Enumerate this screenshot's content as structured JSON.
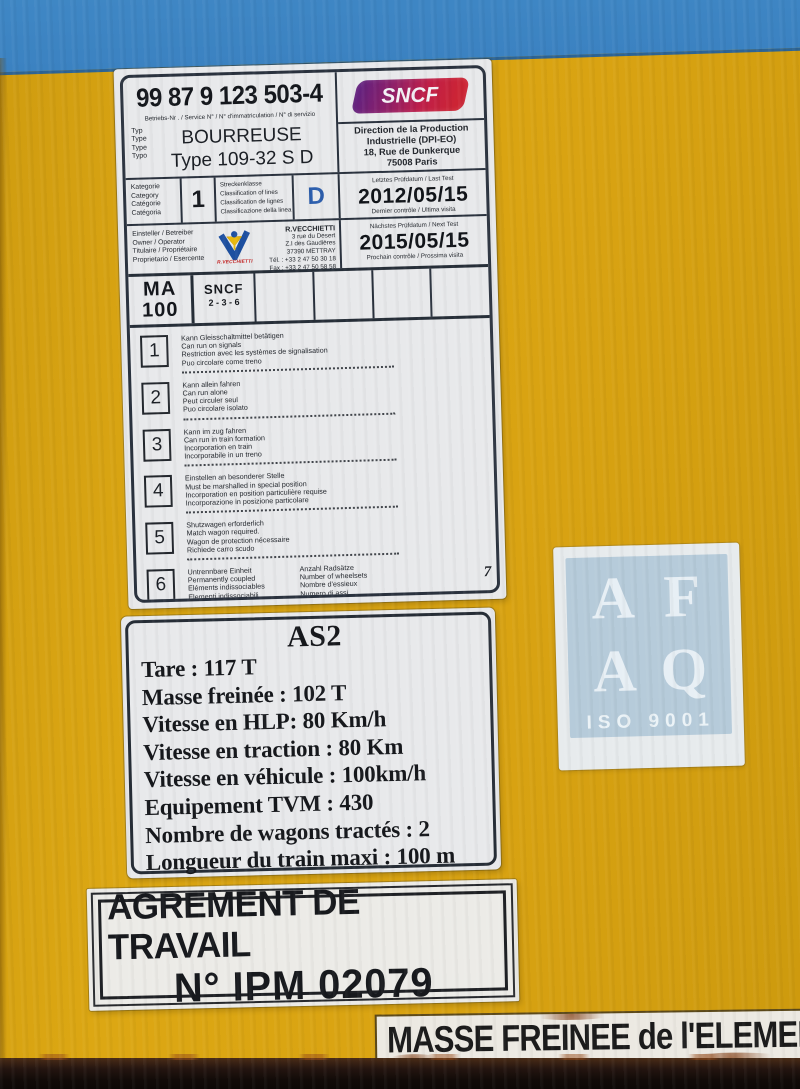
{
  "colors": {
    "sky_blue": "#3d86c5",
    "body_yellow": "#d9a312",
    "plate_bg": "#e8e9eb",
    "plate_border": "#2a323e",
    "class_d_blue": "#2d5fae",
    "sncf_purple": "#64217e",
    "sncf_red": "#cc2434",
    "vecchietti_red": "#c32222",
    "sticker_blue": "#b6cbda",
    "bottom_band": "#120b08"
  },
  "plate1": {
    "number": "99 87 9 123 503-4",
    "number_label": "Betriebs-Nr . / Service N° / N° d'immatriculation / N° di servizio",
    "type_labels": [
      "Typ",
      "Type",
      "Type",
      "Typo"
    ],
    "type_name": "BOURREUSE",
    "type_model": "Type 109-32 S D",
    "sncf_logo_text": "SNCF",
    "direction": [
      "Direction de la Production",
      "Industrielle (DPI-EO)",
      "18, Rue de Dunkerque",
      "75008 Paris"
    ],
    "category_labels": [
      "Kategorie",
      "Category",
      "Catégorie",
      "Catégoria"
    ],
    "category_value": "1",
    "class_labels": [
      "Streckenklasse",
      "Classification of lines",
      "Classification de lignes",
      "Classificazione della linea"
    ],
    "class_value": "D",
    "last_test": {
      "top": "Letztes Prüfdatum / Last Test",
      "date": "2012/05/15",
      "bottom": "Dernier contrôle / Ultima visita"
    },
    "next_test": {
      "top": "Nächstes Prüfdatum / Next Test",
      "date": "2015/05/15",
      "bottom": "Prochain contrôle / Prossima visita"
    },
    "owner_labels": [
      "Einsteller / Betreiber",
      "Owner / Operator",
      "Titulaire / Propriétaire",
      "Proprietario / Esercente"
    ],
    "owner_logo_caption": "R.VECCHIETTI",
    "owner_address": [
      "R.VECCHIETTI",
      "3 rue du Desert",
      "Z.I des Gaudières",
      "37390 METTRAY",
      "Tél. : +33 2 47 50 30 18",
      "Fax : +33 2 47 50 58 58"
    ],
    "ma_cell": {
      "line1": "MA",
      "line2": "100"
    },
    "sncf_cell": {
      "line1": "SNCF",
      "line2": "2 - 3 - 6"
    },
    "items": [
      {
        "num": "1",
        "lines": [
          "Kann Gleisschaltmittel betätigen",
          "Can run on signals",
          "Restriction avec les systèmes de signalisation",
          "Puo circolare come treno"
        ]
      },
      {
        "num": "2",
        "lines": [
          "Kann allein fahren",
          "Can run alone",
          "Peut circuler seul",
          "Puo circolare isolato"
        ]
      },
      {
        "num": "3",
        "lines": [
          "Kann im zug fahren",
          "Can run in train formation",
          "Incorporation en train",
          "Incorporabile in un treno"
        ]
      },
      {
        "num": "4",
        "lines": [
          "Einstellen an besonderer Stelle",
          "Must be marshalled in special position",
          "Incorporation en position particulière requise",
          "Incorporazione in posizione particolare"
        ]
      },
      {
        "num": "5",
        "lines": [
          "Shutzwagen erforderlich",
          "Match wagon required.",
          "Wagon de protection nécessaire",
          "Richiede carro scudo"
        ]
      },
      {
        "num": "6",
        "lines": [
          "Untrennbare Einheit",
          "Permanently coupled",
          "Eléments indissociables",
          "Elementi indissociabili"
        ]
      }
    ],
    "wheelsets": {
      "lines": [
        "Anzahl Radsätze",
        "Number of wheelsets",
        "Nombre d'essieux",
        "Numero di assi"
      ],
      "value": "7"
    }
  },
  "plate2": {
    "title": "AS2",
    "lines": [
      "Tare : 117 T",
      "Masse freinée : 102 T",
      "Vitesse en HLP: 80 Km/h",
      "Vitesse en traction : 80 Km",
      "Vitesse en véhicule : 100km/h",
      "Equipement TVM  : 430",
      "Nombre de wagons tractés : 2",
      "Longueur du train maxi : 100 m"
    ]
  },
  "plate3": {
    "line1": "AGREMENT DE TRAVAIL",
    "line2": "N° IPM 02079"
  },
  "masse_strip": {
    "text": "MASSE FREINEE de l'ELEMEN"
  },
  "iso_sticker": {
    "letters": [
      "A",
      "F",
      "A",
      "Q"
    ],
    "caption": "ISO 9001"
  }
}
